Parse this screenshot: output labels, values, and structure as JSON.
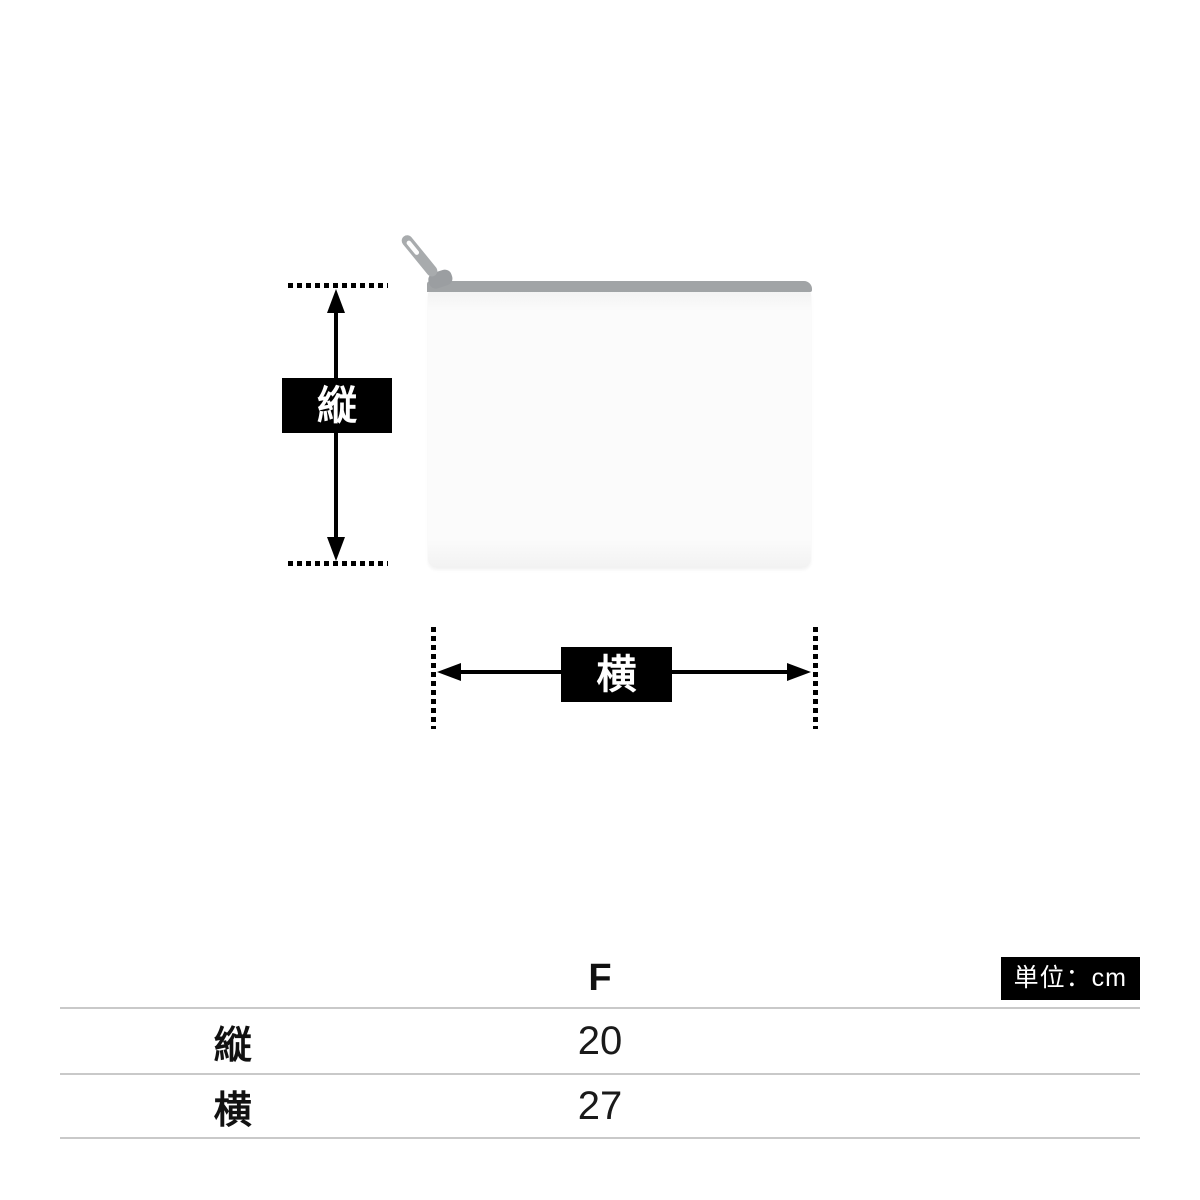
{
  "diagram": {
    "vertical_label": "縦",
    "horizontal_label": "横"
  },
  "table": {
    "unit_badge": "単位：cm",
    "size_header": "F",
    "rows": [
      {
        "label": "縦",
        "value": "20"
      },
      {
        "label": "横",
        "value": "27"
      }
    ]
  },
  "colors": {
    "label_box_bg": "#000000",
    "label_box_text": "#ffffff",
    "zipper_gray": "#a1a4a6",
    "pouch_body": "#fbfbfb",
    "table_line": "#c9c9c9",
    "background": "#ffffff"
  }
}
